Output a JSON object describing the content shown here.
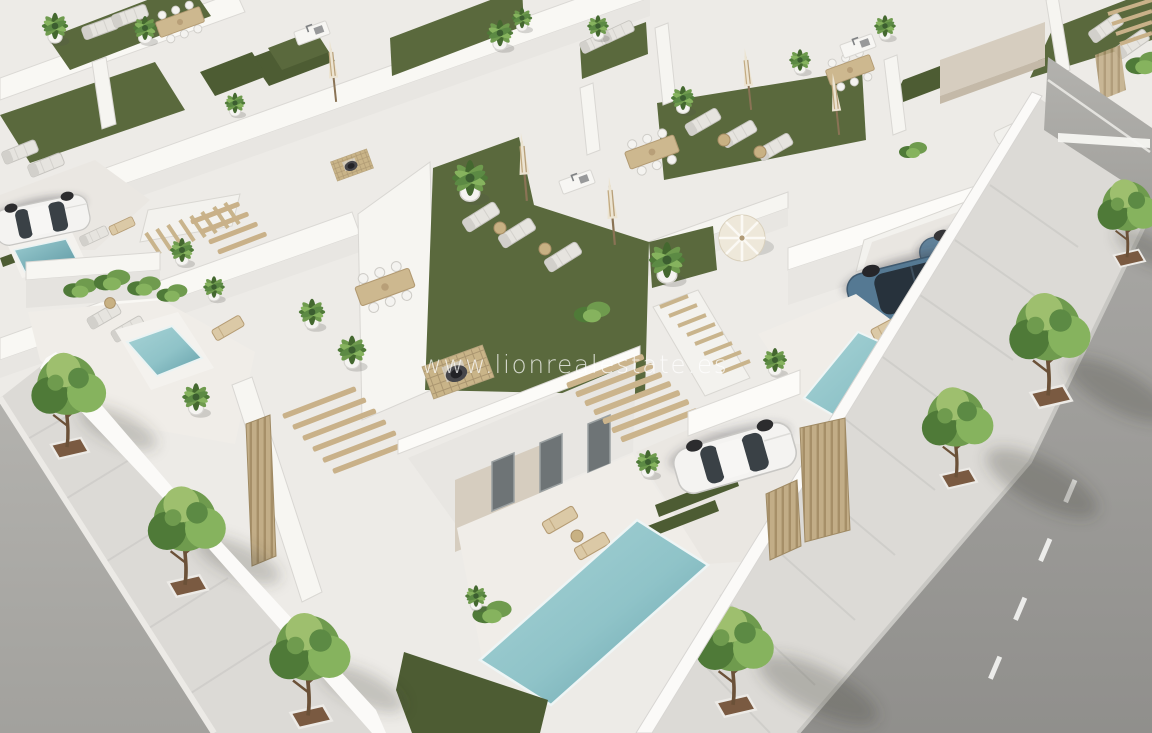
{
  "watermark": {
    "text": "www.lionrealestate.es",
    "color": "#ffffff",
    "opacity": 0.74
  },
  "alt": "Aerial 3D render of a modern white villa development with rooftop turf terraces, sun loungers, parasols, dining sets, private plunge pools, parked cars and tree-lined streets",
  "palette": {
    "canvas": "#edebe7",
    "white_wall": "#f7f6f2",
    "white_bright": "#fcfbf8",
    "wall_shade": "#e8e6e2",
    "paving": "#f0ede8",
    "stone": "#d6cdbf",
    "turf": "#5a693d",
    "turf_dark": "#4d5c33",
    "pool": "#8fc3c8",
    "pool_deep": "#649fa9",
    "asphalt": "#9b9a97",
    "asphalt_light": "#adacaa",
    "sidewalk": "#dcdad6",
    "wood": "#c9b189",
    "wood_dark": "#b2986f",
    "tree": "#6f9b4e",
    "tree_light": "#9ebf6e",
    "tree_dark": "#4f7a38",
    "soil": "#7a5a41",
    "car_blue": "#557993",
    "car_blue_dark": "#3f4e5a",
    "glass": "#3a4146"
  },
  "inventory": {
    "street_trees": 7,
    "parked_vehicles": [
      "white sedan",
      "white sedan",
      "blue SUV",
      "dark blue SUV"
    ],
    "pools": 5,
    "roof_terraces_with_turf": "multiple rows"
  }
}
